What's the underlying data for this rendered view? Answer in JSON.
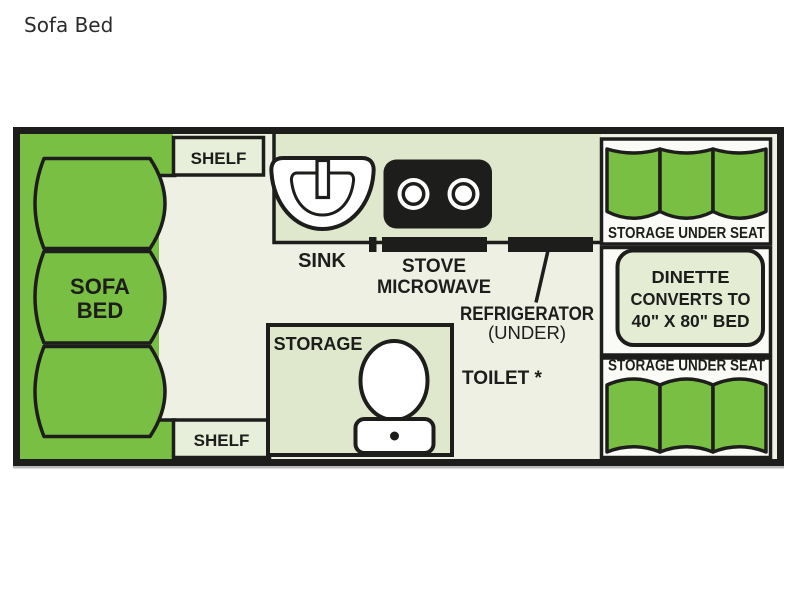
{
  "title": "Sofa Bed",
  "floorplan": {
    "sofa_bed": {
      "line1": "SOFA",
      "line2": "BED"
    },
    "shelf_top": "SHELF",
    "shelf_bottom": "SHELF",
    "sink_label": "SINK",
    "stove_label": "STOVE",
    "microwave_label": "MICROWAVE",
    "refrigerator_label": "REFRIGERATOR",
    "refrigerator_sub": "(UNDER)",
    "toilet_label": "TOILET *",
    "storage_label": "STORAGE",
    "storage_under_seat_top": "STORAGE UNDER SEAT",
    "storage_under_seat_bottom": "STORAGE UNDER SEAT",
    "dinette": {
      "line1": "DINETTE",
      "line2": "CONVERTS TO",
      "line3": "40\" X 80\" BED"
    }
  },
  "colors": {
    "cushion_green": "#79bf43",
    "floor": "#edf0e3",
    "counter_tint": "#dfe8cc",
    "shelf_tint": "#e7eed9",
    "dinette_pad": "#e4ecd4",
    "panel_bg": "#fafbf6",
    "outline": "#1d1d1b"
  }
}
